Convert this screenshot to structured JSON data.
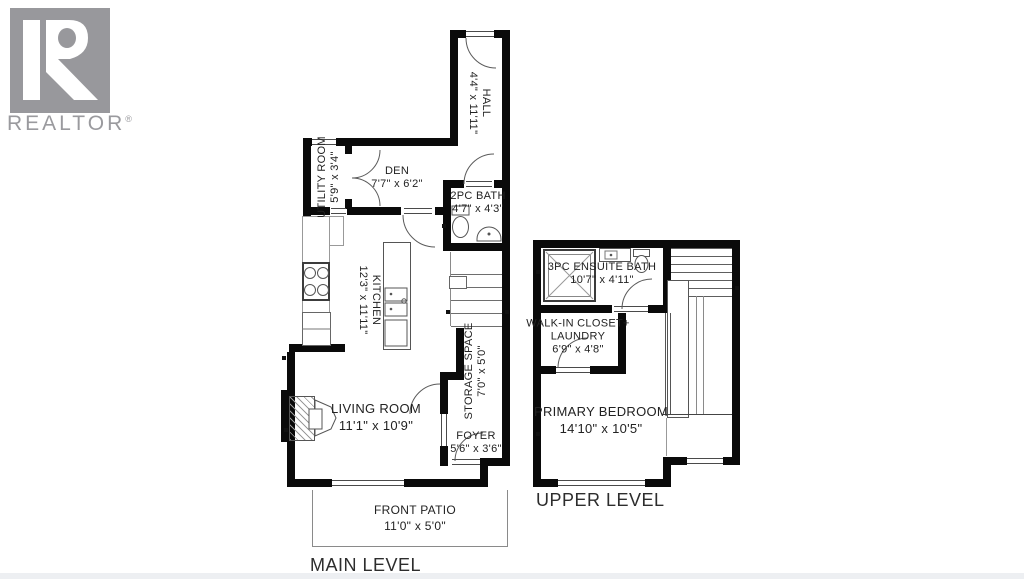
{
  "logo": {
    "brand": "REALTOR",
    "reg": "®"
  },
  "main_level": {
    "label": "MAIN LEVEL",
    "rooms": {
      "hall": {
        "name": "HALL",
        "dims": "4'4\" x 11'11\""
      },
      "utility": {
        "name": "UTILITY ROOM",
        "dims": "5'9\" x 3'4\""
      },
      "den": {
        "name": "DEN",
        "dims": "7'7\" x 6'2\""
      },
      "bath2pc": {
        "name": "2PC BATH",
        "dims": "4'7\" x 4'3\""
      },
      "kitchen": {
        "name": "KITCHEN",
        "dims": "12'3\" x 11'11\""
      },
      "storage": {
        "name": "STORAGE SPACE",
        "dims": "7'0\" x 5'0\""
      },
      "living": {
        "name": "LIVING ROOM",
        "dims": "11'1\" x 10'9\""
      },
      "foyer": {
        "name": "FOYER",
        "dims": "5'6\" x 3'6\""
      },
      "patio": {
        "name": "FRONT PATIO",
        "dims": "11'0\" x 5'0\""
      }
    }
  },
  "upper_level": {
    "label": "UPPER LEVEL",
    "rooms": {
      "ensuite": {
        "name": "3PC ENSUITE BATH",
        "dims": "10'7\" x 4'11\""
      },
      "closet": {
        "name": "WALK-IN CLOSET+\nLAUNDRY",
        "dims": "6'9\" x 4'8\""
      },
      "bedroom": {
        "name": "PRIMARY BEDROOM",
        "dims": "14'10\" x 10'5\""
      }
    }
  }
}
